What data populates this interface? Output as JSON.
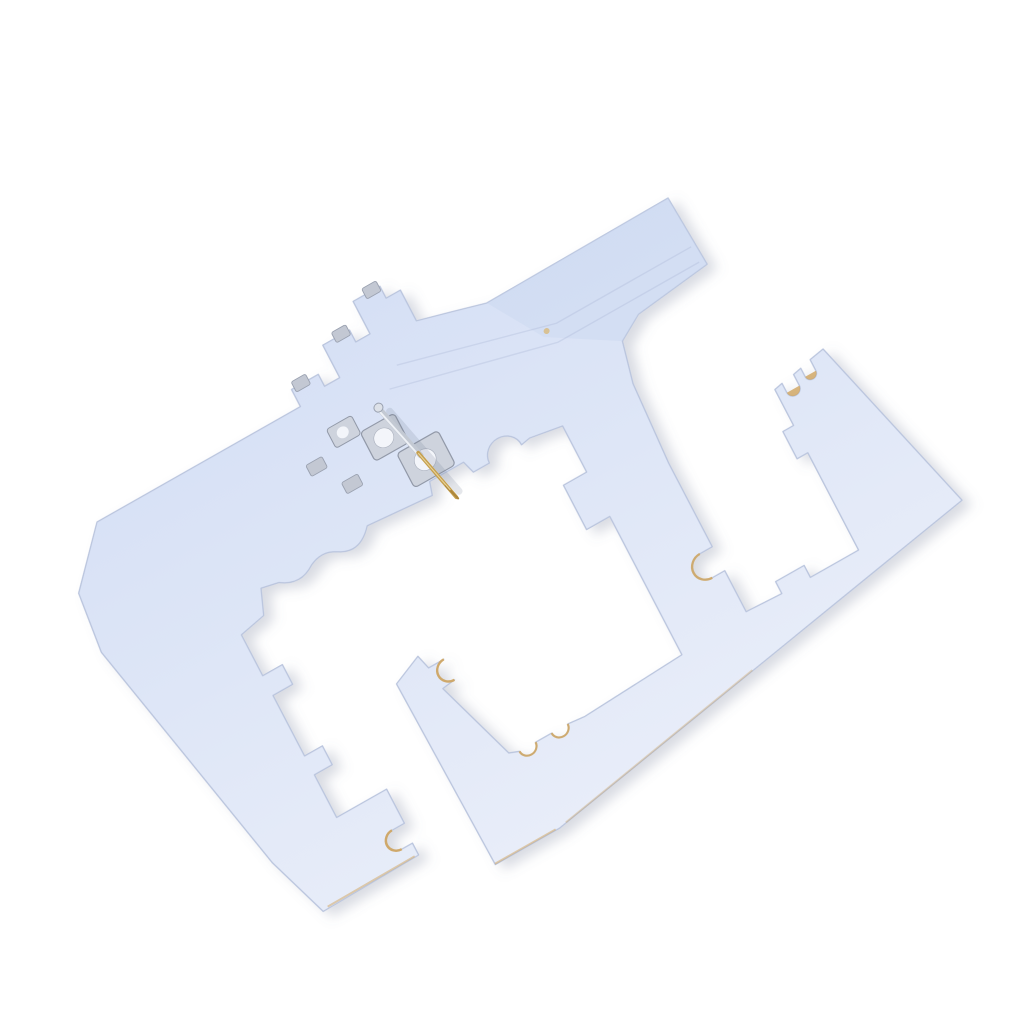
{
  "scene": {
    "background": "#ffffff",
    "subject": "White flat insulator sheet with frame cutouts, notched edges and a gold probe pin in a metal bracket, photographed at an angle on a white background",
    "sheet": {
      "fill_top": "#d6e0f5",
      "fill_bottom": "#e8edf9",
      "edge": "#b9c4dd",
      "shade": "#c7d4ee",
      "crease": "#a9b5d3",
      "substrate_tan": "#cfa45e",
      "pinhole_tan": "#d8bc82"
    },
    "metal": {
      "plate_fill": "#ced3dd",
      "plate_edge": "#9299a8",
      "hole_fill": "#f3f5fa",
      "chip_fill": "#c3c8d3",
      "chip_edge": "#9aa1b0"
    },
    "pin": {
      "silver": "#c3c9d3",
      "silver_highlight": "#eef1f6",
      "gold": "#c59f4e",
      "gold_dark": "#ad873b",
      "gold_glint": "#e8d49a",
      "ball_fill": "#dde1e8",
      "shadow": "rgba(110,120,145,0.18)"
    },
    "shadow": {
      "color": "#6e7891",
      "opacity": 0.26
    }
  }
}
